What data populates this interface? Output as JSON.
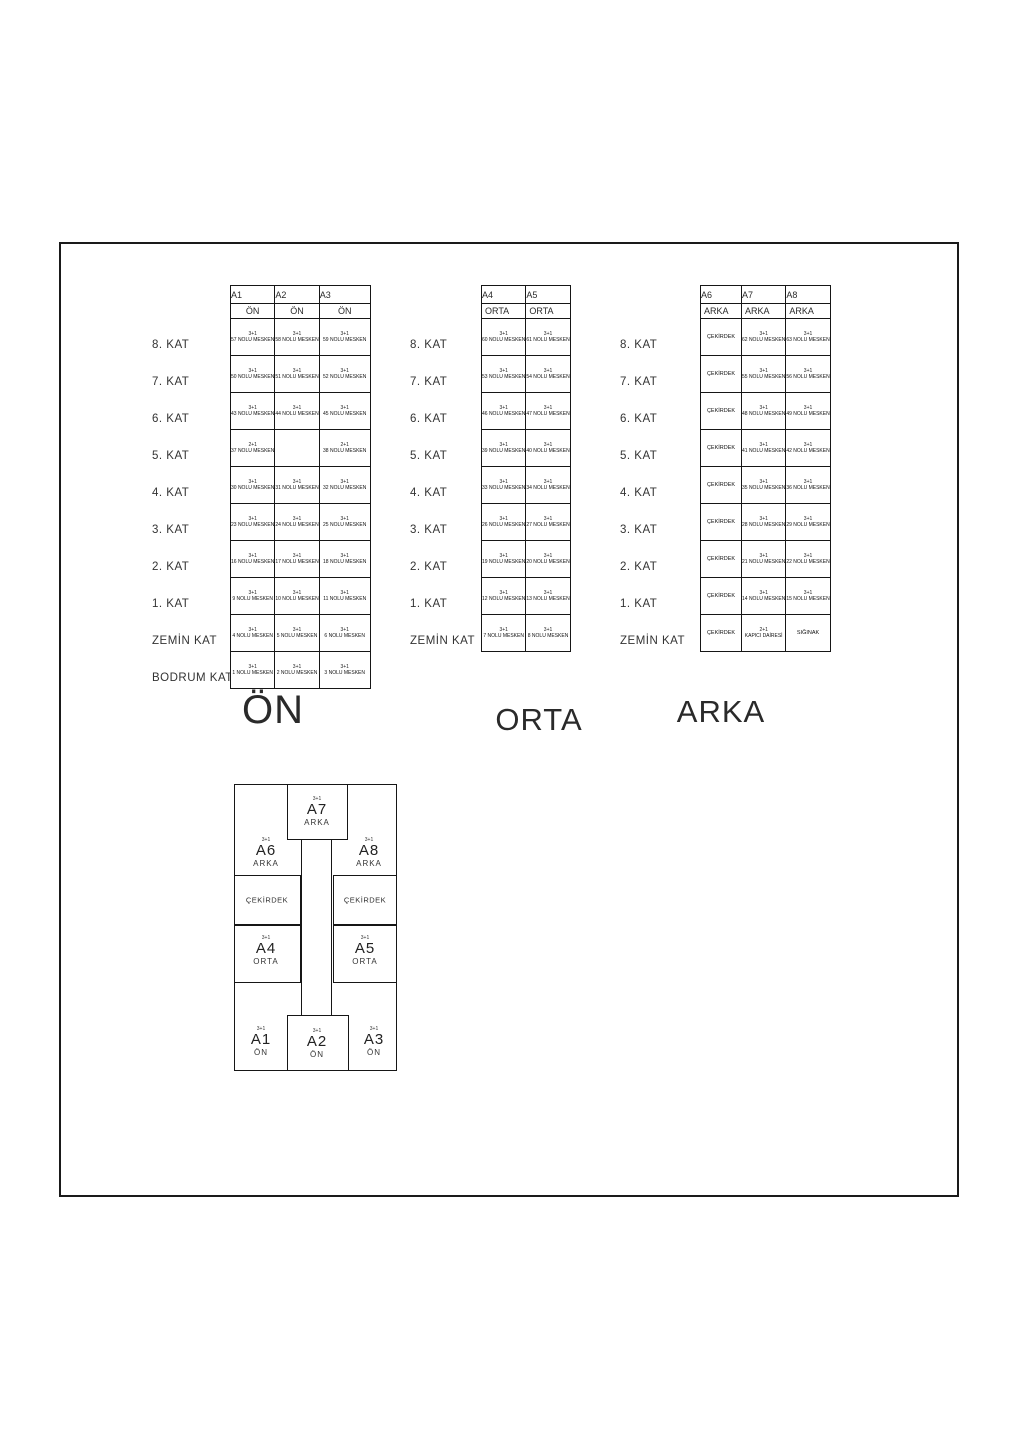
{
  "page": {
    "background": "#ffffff",
    "ink": "#1a1a1a"
  },
  "schedules": [
    {
      "id": "on",
      "title": "ÖN",
      "columns": [
        "A1",
        "A2",
        "A3"
      ],
      "section_row": [
        "ÖN",
        "ÖN",
        "ÖN"
      ],
      "floors": [
        {
          "label": "8. KAT",
          "cells": [
            {
              "type": "3+1",
              "unit": "57 NOLU MESKEN"
            },
            {
              "type": "3+1",
              "unit": "58 NOLU MESKEN"
            },
            {
              "type": "3+1",
              "unit": "59 NOLU MESKEN"
            }
          ]
        },
        {
          "label": "7. KAT",
          "cells": [
            {
              "type": "3+1",
              "unit": "50 NOLU MESKEN"
            },
            {
              "type": "3+1",
              "unit": "51 NOLU MESKEN"
            },
            {
              "type": "3+1",
              "unit": "52 NOLU MESKEN"
            }
          ]
        },
        {
          "label": "6. KAT",
          "cells": [
            {
              "type": "3+1",
              "unit": "43 NOLU MESKEN"
            },
            {
              "type": "3+1",
              "unit": "44 NOLU MESKEN"
            },
            {
              "type": "3+1",
              "unit": "45 NOLU MESKEN"
            }
          ]
        },
        {
          "label": "5. KAT",
          "cells": [
            {
              "type": "2+1",
              "unit": "37 NOLU MESKEN"
            },
            null,
            {
              "type": "2+1",
              "unit": "38 NOLU MESKEN"
            }
          ]
        },
        {
          "label": "4. KAT",
          "cells": [
            {
              "type": "3+1",
              "unit": "30 NOLU MESKEN"
            },
            {
              "type": "3+1",
              "unit": "31 NOLU MESKEN"
            },
            {
              "type": "3+1",
              "unit": "32 NOLU MESKEN"
            }
          ]
        },
        {
          "label": "3. KAT",
          "cells": [
            {
              "type": "3+1",
              "unit": "23 NOLU MESKEN"
            },
            {
              "type": "3+1",
              "unit": "24 NOLU MESKEN"
            },
            {
              "type": "3+1",
              "unit": "25 NOLU MESKEN"
            }
          ]
        },
        {
          "label": "2. KAT",
          "cells": [
            {
              "type": "3+1",
              "unit": "16 NOLU MESKEN"
            },
            {
              "type": "3+1",
              "unit": "17 NOLU MESKEN"
            },
            {
              "type": "3+1",
              "unit": "18 NOLU MESKEN"
            }
          ]
        },
        {
          "label": "1. KAT",
          "cells": [
            {
              "type": "3+1",
              "unit": "9 NOLU MESKEN"
            },
            {
              "type": "3+1",
              "unit": "10 NOLU MESKEN"
            },
            {
              "type": "3+1",
              "unit": "11 NOLU MESKEN"
            }
          ]
        },
        {
          "label": "ZEMİN KAT",
          "cells": [
            {
              "type": "3+1",
              "unit": "4 NOLU MESKEN"
            },
            {
              "type": "3+1",
              "unit": "5 NOLU MESKEN"
            },
            {
              "type": "3+1",
              "unit": "6 NOLU MESKEN"
            }
          ]
        },
        {
          "label": "BODRUM KAT",
          "cells": [
            {
              "type": "3+1",
              "unit": "1 NOLU MESKEN"
            },
            {
              "type": "3+1",
              "unit": "2 NOLU MESKEN"
            },
            {
              "type": "3+1",
              "unit": "3 NOLU MESKEN"
            }
          ]
        }
      ]
    },
    {
      "id": "orta",
      "title": "ORTA",
      "columns": [
        "A4",
        "A5"
      ],
      "section_row": [
        "ORTA",
        "ORTA"
      ],
      "floors": [
        {
          "label": "8. KAT",
          "cells": [
            {
              "type": "3+1",
              "unit": "60 NOLU MESKEN"
            },
            {
              "type": "3+1",
              "unit": "61 NOLU MESKEN"
            }
          ]
        },
        {
          "label": "7. KAT",
          "cells": [
            {
              "type": "3+1",
              "unit": "53 NOLU MESKEN"
            },
            {
              "type": "3+1",
              "unit": "54 NOLU MESKEN"
            }
          ]
        },
        {
          "label": "6. KAT",
          "cells": [
            {
              "type": "3+1",
              "unit": "46 NOLU MESKEN"
            },
            {
              "type": "3+1",
              "unit": "47 NOLU MESKEN"
            }
          ]
        },
        {
          "label": "5. KAT",
          "cells": [
            {
              "type": "3+1",
              "unit": "39 NOLU MESKEN"
            },
            {
              "type": "3+1",
              "unit": "40 NOLU MESKEN"
            }
          ]
        },
        {
          "label": "4. KAT",
          "cells": [
            {
              "type": "3+1",
              "unit": "33 NOLU MESKEN"
            },
            {
              "type": "3+1",
              "unit": "34 NOLU MESKEN"
            }
          ]
        },
        {
          "label": "3. KAT",
          "cells": [
            {
              "type": "3+1",
              "unit": "26 NOLU MESKEN"
            },
            {
              "type": "3+1",
              "unit": "27 NOLU MESKEN"
            }
          ]
        },
        {
          "label": "2. KAT",
          "cells": [
            {
              "type": "3+1",
              "unit": "19 NOLU MESKEN"
            },
            {
              "type": "3+1",
              "unit": "20 NOLU MESKEN"
            }
          ]
        },
        {
          "label": "1. KAT",
          "cells": [
            {
              "type": "3+1",
              "unit": "12 NOLU MESKEN"
            },
            {
              "type": "3+1",
              "unit": "13 NOLU MESKEN"
            }
          ]
        },
        {
          "label": "ZEMİN KAT",
          "cells": [
            {
              "type": "3+1",
              "unit": "7 NOLU MESKEN"
            },
            {
              "type": "3+1",
              "unit": "8 NOLU MESKEN"
            }
          ]
        }
      ]
    },
    {
      "id": "arka",
      "title": "ARKA",
      "columns": [
        "A6",
        "A7",
        "A8"
      ],
      "section_row": [
        "ARKA",
        "ARKA",
        "ARKA"
      ],
      "floors": [
        {
          "label": "8. KAT",
          "cells": [
            {
              "unit": "ÇEKİRDEK"
            },
            {
              "type": "3+1",
              "unit": "62 NOLU MESKEN"
            },
            {
              "type": "3+1",
              "unit": "63 NOLU MESKEN"
            }
          ]
        },
        {
          "label": "7. KAT",
          "cells": [
            {
              "unit": "ÇEKİRDEK"
            },
            {
              "type": "3+1",
              "unit": "55 NOLU MESKEN"
            },
            {
              "type": "3+1",
              "unit": "56 NOLU MESKEN"
            }
          ]
        },
        {
          "label": "6. KAT",
          "cells": [
            {
              "unit": "ÇEKİRDEK"
            },
            {
              "type": "3+1",
              "unit": "48 NOLU MESKEN"
            },
            {
              "type": "3+1",
              "unit": "49 NOLU MESKEN"
            }
          ]
        },
        {
          "label": "5. KAT",
          "cells": [
            {
              "unit": "ÇEKİRDEK"
            },
            {
              "type": "3+1",
              "unit": "41 NOLU MESKEN"
            },
            {
              "type": "3+1",
              "unit": "42 NOLU MESKEN"
            }
          ]
        },
        {
          "label": "4. KAT",
          "cells": [
            {
              "unit": "ÇEKİRDEK"
            },
            {
              "type": "3+1",
              "unit": "35 NOLU MESKEN"
            },
            {
              "type": "3+1",
              "unit": "36 NOLU MESKEN"
            }
          ]
        },
        {
          "label": "3. KAT",
          "cells": [
            {
              "unit": "ÇEKİRDEK"
            },
            {
              "type": "3+1",
              "unit": "28 NOLU MESKEN"
            },
            {
              "type": "3+1",
              "unit": "29 NOLU MESKEN"
            }
          ]
        },
        {
          "label": "2. KAT",
          "cells": [
            {
              "unit": "ÇEKİRDEK"
            },
            {
              "type": "3+1",
              "unit": "21 NOLU MESKEN"
            },
            {
              "type": "3+1",
              "unit": "22 NOLU MESKEN"
            }
          ]
        },
        {
          "label": "1. KAT",
          "cells": [
            {
              "unit": "ÇEKİRDEK"
            },
            {
              "type": "3+1",
              "unit": "14 NOLU MESKEN"
            },
            {
              "type": "3+1",
              "unit": "15 NOLU MESKEN"
            }
          ]
        },
        {
          "label": "ZEMİN KAT",
          "cells": [
            {
              "unit": "ÇEKİRDEK"
            },
            {
              "type": "2+1",
              "unit": "KAPICI DAİRESİ"
            },
            {
              "unit": "SIĞINAK"
            }
          ]
        }
      ]
    }
  ],
  "plan": {
    "core_label": "ÇEKİRDEK",
    "units": [
      {
        "id": "A7",
        "type": "3+1",
        "zone": "ARKA"
      },
      {
        "id": "A6",
        "type": "3+1",
        "zone": "ARKA"
      },
      {
        "id": "A8",
        "type": "3+1",
        "zone": "ARKA"
      },
      {
        "id": "A4",
        "type": "3+1",
        "zone": "ORTA"
      },
      {
        "id": "A5",
        "type": "3+1",
        "zone": "ORTA"
      },
      {
        "id": "A1",
        "type": "3+1",
        "zone": "ÖN"
      },
      {
        "id": "A2",
        "type": "3+1",
        "zone": "ÖN"
      },
      {
        "id": "A3",
        "type": "3+1",
        "zone": "ÖN"
      }
    ]
  }
}
